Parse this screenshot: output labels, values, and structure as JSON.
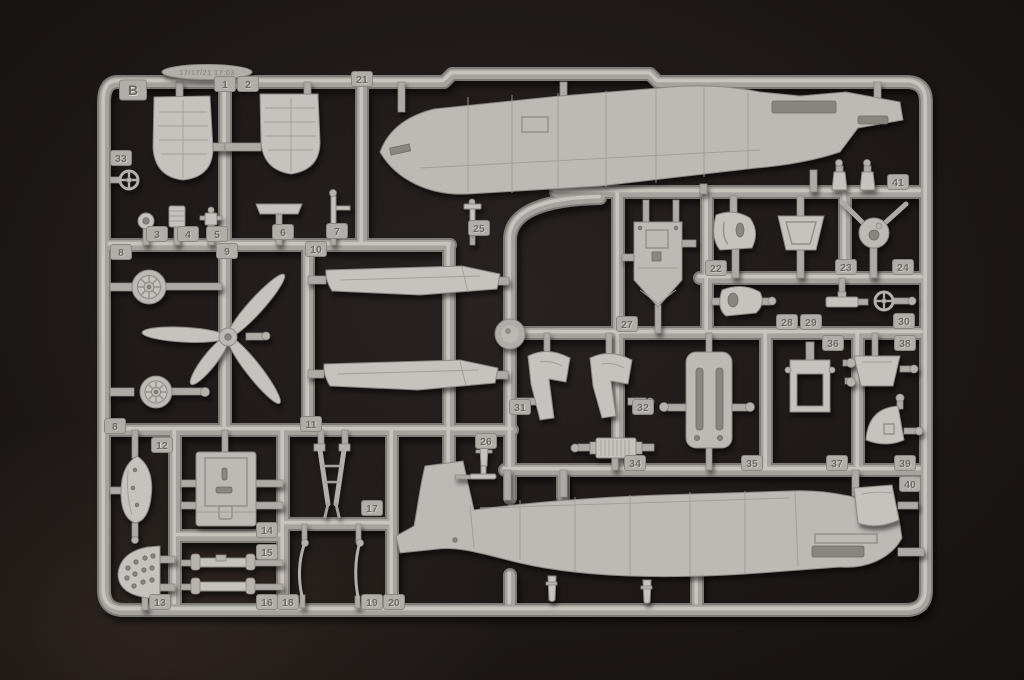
{
  "photo": {
    "description": "Light-grey injection-moulded model kit sprue (runner B) with numbered aircraft parts, photographed on a dark brown-black background",
    "background_color": "#1d1815",
    "plastic_color": "#b7b3ae"
  },
  "sprue": {
    "letter": "B",
    "mold_stamp": "17/17/21 17:03",
    "highest_part_number": 41,
    "tags": [
      {
        "label": "B",
        "x": 133,
        "y": 90,
        "size": "large"
      },
      {
        "label": "1",
        "x": 225,
        "y": 84
      },
      {
        "label": "2",
        "x": 248,
        "y": 84
      },
      {
        "label": "21",
        "x": 362,
        "y": 79
      },
      {
        "label": "33",
        "x": 121,
        "y": 158
      },
      {
        "label": "3",
        "x": 157,
        "y": 234
      },
      {
        "label": "4",
        "x": 188,
        "y": 234
      },
      {
        "label": "5",
        "x": 217,
        "y": 234
      },
      {
        "label": "6",
        "x": 283,
        "y": 232
      },
      {
        "label": "7",
        "x": 337,
        "y": 231
      },
      {
        "label": "25",
        "x": 479,
        "y": 228
      },
      {
        "label": "8",
        "x": 121,
        "y": 252
      },
      {
        "label": "9",
        "x": 227,
        "y": 251
      },
      {
        "label": "10",
        "x": 316,
        "y": 249
      },
      {
        "label": "41",
        "x": 898,
        "y": 182
      },
      {
        "label": "22",
        "x": 716,
        "y": 268
      },
      {
        "label": "23",
        "x": 846,
        "y": 267
      },
      {
        "label": "24",
        "x": 903,
        "y": 267
      },
      {
        "label": "27",
        "x": 627,
        "y": 324
      },
      {
        "label": "28",
        "x": 787,
        "y": 322
      },
      {
        "label": "29",
        "x": 811,
        "y": 322
      },
      {
        "label": "30",
        "x": 904,
        "y": 321
      },
      {
        "label": "36",
        "x": 833,
        "y": 343
      },
      {
        "label": "38",
        "x": 905,
        "y": 343
      },
      {
        "label": "8",
        "x": 115,
        "y": 426
      },
      {
        "label": "11",
        "x": 311,
        "y": 424
      },
      {
        "label": "12",
        "x": 162,
        "y": 445
      },
      {
        "label": "31",
        "x": 520,
        "y": 407
      },
      {
        "label": "32",
        "x": 643,
        "y": 407
      },
      {
        "label": "26",
        "x": 486,
        "y": 441
      },
      {
        "label": "34",
        "x": 635,
        "y": 463
      },
      {
        "label": "35",
        "x": 752,
        "y": 463
      },
      {
        "label": "37",
        "x": 837,
        "y": 463
      },
      {
        "label": "39",
        "x": 905,
        "y": 463
      },
      {
        "label": "40",
        "x": 910,
        "y": 484
      },
      {
        "label": "14",
        "x": 267,
        "y": 530
      },
      {
        "label": "15",
        "x": 267,
        "y": 552
      },
      {
        "label": "17",
        "x": 372,
        "y": 508
      },
      {
        "label": "13",
        "x": 160,
        "y": 602
      },
      {
        "label": "16",
        "x": 267,
        "y": 602
      },
      {
        "label": "18",
        "x": 288,
        "y": 602
      },
      {
        "label": "19",
        "x": 372,
        "y": 602
      },
      {
        "label": "20",
        "x": 394,
        "y": 602
      }
    ]
  }
}
